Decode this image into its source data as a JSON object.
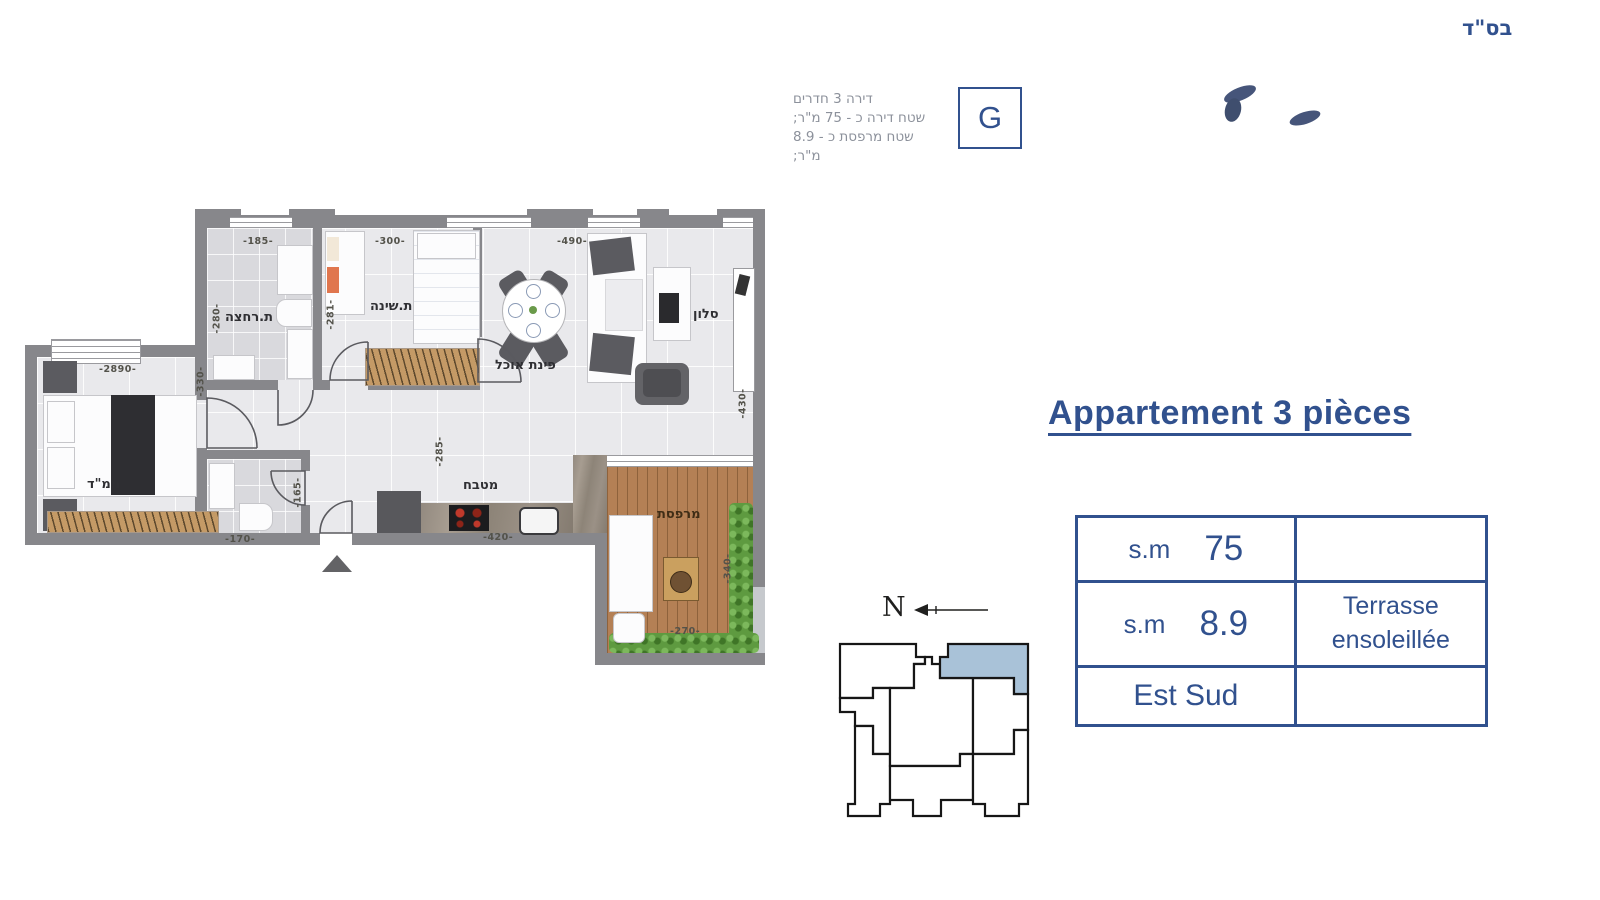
{
  "colors": {
    "accent_blue": "#31518e",
    "keyplan_highlight": "#a9c2d8",
    "wall_gray": "#87878b"
  },
  "header": {
    "bsd": "בס\"ד",
    "unit_letter": "G",
    "info_lines": [
      {
        "text": "דירה 3 חדרים"
      },
      {
        "text": "שטח דירה כ - 75 מ\"ר;"
      },
      {
        "text": "שטח מרפסת כ - 8.9 מ\"ר;"
      }
    ]
  },
  "title": {
    "text": "Appartement 3 pièces"
  },
  "spec_table": {
    "rows": [
      {
        "unit": "s.m",
        "value": "75",
        "right": ""
      },
      {
        "unit": "s.m",
        "value": "8.9",
        "right": "Terrasse ensoleillée"
      },
      {
        "unit": "Est Sud",
        "value": "",
        "right": ""
      }
    ]
  },
  "compass": {
    "label": "N"
  },
  "plan": {
    "rooms": [
      {
        "id": "bathroom",
        "label": "ת.רחצה"
      },
      {
        "id": "bedroom",
        "label": "ת.שינה"
      },
      {
        "id": "dining",
        "label": "פינת אוכל"
      },
      {
        "id": "salon",
        "label": "סלון"
      },
      {
        "id": "mamad",
        "label": "ממ\"ד"
      },
      {
        "id": "kitchen",
        "label": "מטבח"
      },
      {
        "id": "balcony",
        "label": "מרפסת"
      }
    ],
    "dims": [
      {
        "text": "-185-"
      },
      {
        "text": "-300-"
      },
      {
        "text": "-490-"
      },
      {
        "text": "-280-"
      },
      {
        "text": "-281-"
      },
      {
        "text": "-2890-"
      },
      {
        "text": "-330-"
      },
      {
        "text": "-430-"
      },
      {
        "text": "-285-"
      },
      {
        "text": "-165-"
      },
      {
        "text": "-170-"
      },
      {
        "text": "-420-"
      },
      {
        "text": "-340-"
      },
      {
        "text": "-270-"
      }
    ]
  }
}
